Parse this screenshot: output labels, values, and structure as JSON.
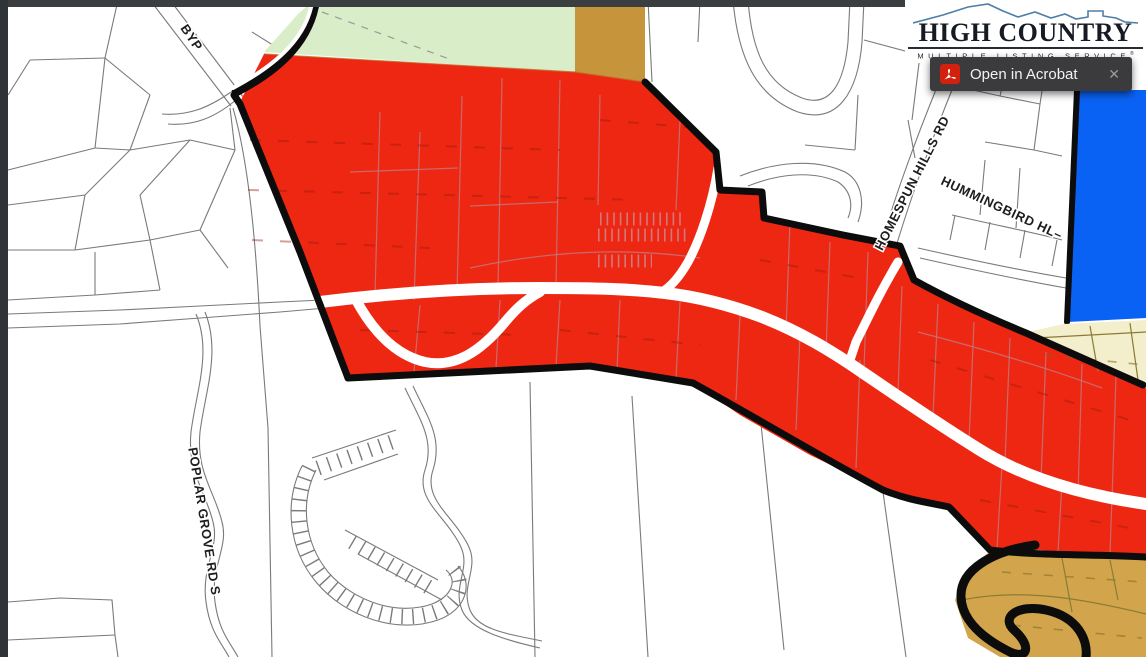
{
  "chrome": {
    "open_in_acrobat_label": "Open in Acrobat",
    "close_label": "✕"
  },
  "logo": {
    "line1": "HIGH COUNTRY",
    "line2": "MULTIPLE LISTING SERVICE",
    "registered": "®"
  },
  "map": {
    "road_labels": {
      "byp": "BYP",
      "poplar_grove": "POPLAR GROVE RD S",
      "homespun_hills": "HOMESPUN HILLS RD",
      "hummingbird": "HUMMINGBIRD HL–"
    },
    "colors": {
      "subject_zone_red": "#EE2712",
      "green_region": "#D9EDC8",
      "tan_region": "#C6953B",
      "gold_region": "#D2A54D",
      "cream_region": "#F3EECB",
      "blue_region": "#0A62F5",
      "boundary_black": "#0C0C0C",
      "parcel_line_gray": "#7A7A7A",
      "acrobat_red": "#D3210E"
    }
  }
}
